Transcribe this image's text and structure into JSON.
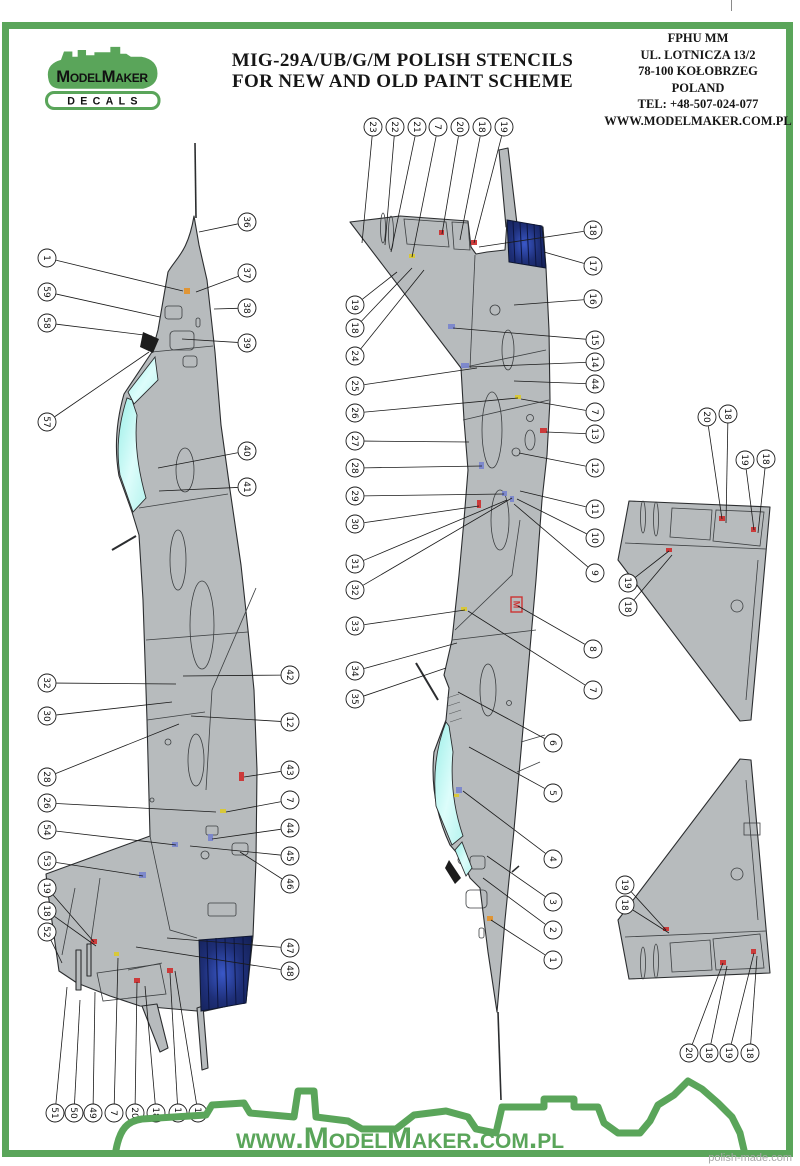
{
  "header": {
    "title_line1": "MIG-29A/UB/G/M POLISH STENCILS",
    "title_line2": "FOR NEW AND OLD PAINT SCHEME"
  },
  "logo": {
    "brand": "ModelMaker",
    "sub": "DECALS"
  },
  "address": {
    "lines": [
      "FPHU MM",
      "UL. LOTNICZA 13/2",
      "78-100 KOŁOBRZEG",
      "POLAND",
      "TEL: +48-507-024-077",
      "WWW.MODELMAKER.COM.PL"
    ]
  },
  "footer": {
    "url": "www.ModelMaker.com.pl",
    "watermark": "polish-made.com"
  },
  "colors": {
    "frame_green": "#5aa55a",
    "aircraft_gray": "#b7bbbd",
    "canopy_cyan": "#aef2ec",
    "nozzle_navy": "#1b2a66",
    "mark_red": "#cc3333",
    "mark_orange": "#e2922d",
    "mark_yellow": "#d9c832",
    "mark_blue": "#7a86cc"
  },
  "callouts": {
    "left_aircraft": [
      {
        "n": "1",
        "cx": 47,
        "cy": 258,
        "tx": 183,
        "ty": 291
      },
      {
        "n": "59",
        "cx": 47,
        "cy": 292,
        "tx": 160,
        "ty": 317
      },
      {
        "n": "58",
        "cx": 47,
        "cy": 323,
        "tx": 152,
        "ty": 336
      },
      {
        "n": "57",
        "cx": 47,
        "cy": 422,
        "tx": 149,
        "ty": 352
      },
      {
        "n": "32",
        "cx": 47,
        "cy": 683,
        "tx": 176,
        "ty": 684
      },
      {
        "n": "30",
        "cx": 47,
        "cy": 716,
        "tx": 172,
        "ty": 702
      },
      {
        "n": "28",
        "cx": 47,
        "cy": 777,
        "tx": 179,
        "ty": 724
      },
      {
        "n": "26",
        "cx": 47,
        "cy": 803,
        "tx": 216,
        "ty": 812
      },
      {
        "n": "54",
        "cx": 47,
        "cy": 830,
        "tx": 176,
        "ty": 845
      },
      {
        "n": "53",
        "cx": 47,
        "cy": 861,
        "tx": 143,
        "ty": 876
      },
      {
        "n": "19",
        "cx": 47,
        "cy": 888,
        "tx": 94,
        "ty": 942
      },
      {
        "n": "18",
        "cx": 47,
        "cy": 911,
        "tx": 96,
        "ty": 946
      },
      {
        "n": "52",
        "cx": 47,
        "cy": 932,
        "tx": 62,
        "ty": 963
      },
      {
        "n": "51",
        "cx": 55,
        "cy": 1113,
        "tx": 67,
        "ty": 987
      },
      {
        "n": "50",
        "cx": 74,
        "cy": 1113,
        "tx": 80,
        "ty": 1000
      },
      {
        "n": "49",
        "cx": 93,
        "cy": 1113,
        "tx": 95,
        "ty": 992
      },
      {
        "n": "7",
        "cx": 114,
        "cy": 1113,
        "tx": 118,
        "ty": 958
      },
      {
        "n": "20",
        "cx": 135,
        "cy": 1113,
        "tx": 137,
        "ty": 982
      },
      {
        "n": "18",
        "cx": 156,
        "cy": 1113,
        "tx": 145,
        "ty": 986
      },
      {
        "n": "19",
        "cx": 178,
        "cy": 1113,
        "tx": 170,
        "ty": 973
      },
      {
        "n": "18",
        "cx": 198,
        "cy": 1113,
        "tx": 175,
        "ty": 971
      },
      {
        "n": "36",
        "cx": 247,
        "cy": 222,
        "tx": 199,
        "ty": 232
      },
      {
        "n": "37",
        "cx": 247,
        "cy": 273,
        "tx": 196,
        "ty": 292
      },
      {
        "n": "38",
        "cx": 247,
        "cy": 308,
        "tx": 214,
        "ty": 309
      },
      {
        "n": "39",
        "cx": 247,
        "cy": 343,
        "tx": 182,
        "ty": 339
      },
      {
        "n": "40",
        "cx": 247,
        "cy": 451,
        "tx": 158,
        "ty": 468
      },
      {
        "n": "41",
        "cx": 247,
        "cy": 487,
        "tx": 159,
        "ty": 491
      },
      {
        "n": "42",
        "cx": 290,
        "cy": 675,
        "tx": 183,
        "ty": 676
      },
      {
        "n": "12",
        "cx": 290,
        "cy": 722,
        "tx": 191,
        "ty": 716
      },
      {
        "n": "43",
        "cx": 290,
        "cy": 770,
        "tx": 244,
        "ty": 777
      },
      {
        "n": "7",
        "cx": 290,
        "cy": 800,
        "tx": 226,
        "ty": 812
      },
      {
        "n": "44",
        "cx": 290,
        "cy": 828,
        "tx": 212,
        "ty": 839
      },
      {
        "n": "45",
        "cx": 290,
        "cy": 856,
        "tx": 190,
        "ty": 846
      },
      {
        "n": "46",
        "cx": 290,
        "cy": 884,
        "tx": 240,
        "ty": 852
      },
      {
        "n": "47",
        "cx": 290,
        "cy": 948,
        "tx": 167,
        "ty": 938
      },
      {
        "n": "48",
        "cx": 290,
        "cy": 971,
        "tx": 136,
        "ty": 947
      }
    ],
    "center_aircraft": [
      {
        "n": "23",
        "cx": 373,
        "cy": 127,
        "tx": 362,
        "ty": 243
      },
      {
        "n": "22",
        "cx": 395,
        "cy": 127,
        "tx": 385,
        "ty": 245
      },
      {
        "n": "21",
        "cx": 417,
        "cy": 127,
        "tx": 391,
        "ty": 252
      },
      {
        "n": "7",
        "cx": 438,
        "cy": 127,
        "tx": 412,
        "ty": 257
      },
      {
        "n": "20",
        "cx": 460,
        "cy": 127,
        "tx": 442,
        "ty": 234
      },
      {
        "n": "18",
        "cx": 482,
        "cy": 127,
        "tx": 460,
        "ty": 240
      },
      {
        "n": "19",
        "cx": 504,
        "cy": 127,
        "tx": 474,
        "ty": 243
      },
      {
        "n": "18",
        "cx": 593,
        "cy": 230,
        "tx": 479,
        "ty": 247
      },
      {
        "n": "17",
        "cx": 593,
        "cy": 266,
        "tx": 544,
        "ty": 252
      },
      {
        "n": "16",
        "cx": 593,
        "cy": 299,
        "tx": 514,
        "ty": 305
      },
      {
        "n": "15",
        "cx": 595,
        "cy": 340,
        "tx": 453,
        "ty": 328
      },
      {
        "n": "14",
        "cx": 595,
        "cy": 362,
        "tx": 470,
        "ty": 367
      },
      {
        "n": "44",
        "cx": 595,
        "cy": 384,
        "tx": 514,
        "ty": 381
      },
      {
        "n": "7",
        "cx": 595,
        "cy": 412,
        "tx": 521,
        "ty": 399
      },
      {
        "n": "13",
        "cx": 595,
        "cy": 434,
        "tx": 546,
        "ty": 432
      },
      {
        "n": "12",
        "cx": 595,
        "cy": 468,
        "tx": 519,
        "ty": 453
      },
      {
        "n": "11",
        "cx": 595,
        "cy": 509,
        "tx": 520,
        "ty": 491
      },
      {
        "n": "10",
        "cx": 595,
        "cy": 538,
        "tx": 517,
        "ty": 499
      },
      {
        "n": "9",
        "cx": 595,
        "cy": 573,
        "tx": 514,
        "ty": 504
      },
      {
        "n": "8",
        "cx": 593,
        "cy": 649,
        "tx": 518,
        "ty": 606
      },
      {
        "n": "7",
        "cx": 593,
        "cy": 690,
        "tx": 468,
        "ty": 611
      },
      {
        "n": "6",
        "cx": 553,
        "cy": 743,
        "tx": 458,
        "ty": 692
      },
      {
        "n": "5",
        "cx": 553,
        "cy": 793,
        "tx": 469,
        "ty": 747
      },
      {
        "n": "4",
        "cx": 553,
        "cy": 859,
        "tx": 463,
        "ty": 791
      },
      {
        "n": "3",
        "cx": 553,
        "cy": 902,
        "tx": 487,
        "ty": 856
      },
      {
        "n": "2",
        "cx": 553,
        "cy": 930,
        "tx": 483,
        "ty": 878
      },
      {
        "n": "1",
        "cx": 553,
        "cy": 960,
        "tx": 491,
        "ty": 920
      },
      {
        "n": "19",
        "cx": 355,
        "cy": 305,
        "tx": 397,
        "ty": 272
      },
      {
        "n": "18",
        "cx": 355,
        "cy": 328,
        "tx": 412,
        "ty": 268
      },
      {
        "n": "24",
        "cx": 355,
        "cy": 356,
        "tx": 424,
        "ty": 270
      },
      {
        "n": "25",
        "cx": 355,
        "cy": 386,
        "tx": 477,
        "ty": 368
      },
      {
        "n": "26",
        "cx": 355,
        "cy": 413,
        "tx": 518,
        "ty": 398
      },
      {
        "n": "27",
        "cx": 355,
        "cy": 441,
        "tx": 469,
        "ty": 442
      },
      {
        "n": "28",
        "cx": 355,
        "cy": 468,
        "tx": 482,
        "ty": 466
      },
      {
        "n": "29",
        "cx": 355,
        "cy": 496,
        "tx": 504,
        "ty": 494
      },
      {
        "n": "30",
        "cx": 355,
        "cy": 524,
        "tx": 479,
        "ty": 506
      },
      {
        "n": "31",
        "cx": 355,
        "cy": 564,
        "tx": 507,
        "ty": 500
      },
      {
        "n": "32",
        "cx": 355,
        "cy": 590,
        "tx": 512,
        "ty": 498
      },
      {
        "n": "33",
        "cx": 355,
        "cy": 626,
        "tx": 465,
        "ty": 610
      },
      {
        "n": "34",
        "cx": 355,
        "cy": 671,
        "tx": 457,
        "ty": 643
      },
      {
        "n": "35",
        "cx": 355,
        "cy": 699,
        "tx": 446,
        "ty": 668
      }
    ],
    "fin_top_view": [
      {
        "n": "20",
        "cx": 707,
        "cy": 417,
        "tx": 722,
        "ty": 519
      },
      {
        "n": "18",
        "cx": 728,
        "cy": 414,
        "tx": 726,
        "ty": 523
      },
      {
        "n": "19",
        "cx": 745,
        "cy": 460,
        "tx": 754,
        "ty": 530
      },
      {
        "n": "18",
        "cx": 766,
        "cy": 459,
        "tx": 758,
        "ty": 533
      },
      {
        "n": "19",
        "cx": 628,
        "cy": 583,
        "tx": 669,
        "ty": 551
      },
      {
        "n": "18",
        "cx": 628,
        "cy": 607,
        "tx": 672,
        "ty": 555
      }
    ],
    "fin_bottom_view": [
      {
        "n": "19",
        "cx": 625,
        "cy": 885,
        "tx": 666,
        "ty": 930
      },
      {
        "n": "18",
        "cx": 625,
        "cy": 905,
        "tx": 669,
        "ty": 933
      },
      {
        "n": "20",
        "cx": 689,
        "cy": 1053,
        "tx": 723,
        "ty": 963
      },
      {
        "n": "18",
        "cx": 709,
        "cy": 1053,
        "tx": 727,
        "ty": 966
      },
      {
        "n": "19",
        "cx": 729,
        "cy": 1053,
        "tx": 754,
        "ty": 953
      },
      {
        "n": "18",
        "cx": 750,
        "cy": 1053,
        "tx": 757,
        "ty": 956
      }
    ]
  },
  "marks": [
    {
      "x": 184,
      "y": 288,
      "w": 6,
      "h": 6,
      "c": "#e2922d"
    },
    {
      "x": 239,
      "y": 772,
      "w": 5,
      "h": 9,
      "c": "#cc3333"
    },
    {
      "x": 220,
      "y": 809,
      "w": 6,
      "h": 4,
      "c": "#d9c832"
    },
    {
      "x": 139,
      "y": 872,
      "w": 7,
      "h": 6,
      "c": "#7a86cc"
    },
    {
      "x": 91,
      "y": 939,
      "w": 6,
      "h": 5,
      "c": "#cc3333"
    },
    {
      "x": 114,
      "y": 952,
      "w": 5,
      "h": 4,
      "c": "#d9c832"
    },
    {
      "x": 134,
      "y": 978,
      "w": 6,
      "h": 5,
      "c": "#cc3333"
    },
    {
      "x": 167,
      "y": 968,
      "w": 6,
      "h": 5,
      "c": "#cc3333"
    },
    {
      "x": 172,
      "y": 842,
      "w": 6,
      "h": 5,
      "c": "#7a86cc"
    },
    {
      "x": 208,
      "y": 834,
      "w": 5,
      "h": 7,
      "c": "#7a86cc"
    },
    {
      "x": 409,
      "y": 254,
      "w": 6,
      "h": 4,
      "c": "#d9c832"
    },
    {
      "x": 439,
      "y": 230,
      "w": 5,
      "h": 5,
      "c": "#cc3333"
    },
    {
      "x": 471,
      "y": 240,
      "w": 6,
      "h": 5,
      "c": "#cc3333"
    },
    {
      "x": 448,
      "y": 324,
      "w": 7,
      "h": 5,
      "c": "#7a86cc"
    },
    {
      "x": 461,
      "y": 363,
      "w": 8,
      "h": 5,
      "c": "#7a86cc"
    },
    {
      "x": 515,
      "y": 395,
      "w": 6,
      "h": 4,
      "c": "#d9c832"
    },
    {
      "x": 540,
      "y": 428,
      "w": 7,
      "h": 5,
      "c": "#cc3333"
    },
    {
      "x": 479,
      "y": 462,
      "w": 5,
      "h": 7,
      "c": "#7a86cc"
    },
    {
      "x": 477,
      "y": 500,
      "w": 4,
      "h": 8,
      "c": "#cc3333"
    },
    {
      "x": 502,
      "y": 491,
      "w": 5,
      "h": 5,
      "c": "#7a86cc"
    },
    {
      "x": 510,
      "y": 496,
      "w": 4,
      "h": 6,
      "c": "#7a86cc"
    },
    {
      "x": 461,
      "y": 607,
      "w": 6,
      "h": 4,
      "c": "#d9c832"
    },
    {
      "x": 456,
      "y": 787,
      "w": 6,
      "h": 6,
      "c": "#7a86cc"
    },
    {
      "x": 454,
      "y": 794,
      "w": 5,
      "h": 3,
      "c": "#d9c832"
    },
    {
      "x": 487,
      "y": 916,
      "w": 6,
      "h": 5,
      "c": "#e2922d"
    },
    {
      "x": 719,
      "y": 516,
      "w": 6,
      "h": 5,
      "c": "#cc3333"
    },
    {
      "x": 751,
      "y": 527,
      "w": 5,
      "h": 5,
      "c": "#cc3333"
    },
    {
      "x": 666,
      "y": 548,
      "w": 6,
      "h": 4,
      "c": "#cc3333"
    },
    {
      "x": 663,
      "y": 927,
      "w": 6,
      "h": 4,
      "c": "#cc3333"
    },
    {
      "x": 720,
      "y": 960,
      "w": 6,
      "h": 5,
      "c": "#cc3333"
    },
    {
      "x": 751,
      "y": 949,
      "w": 5,
      "h": 5,
      "c": "#cc3333"
    }
  ],
  "m_badge": {
    "x": 511,
    "y": 597,
    "w": 11,
    "h": 15,
    "label": "M"
  }
}
